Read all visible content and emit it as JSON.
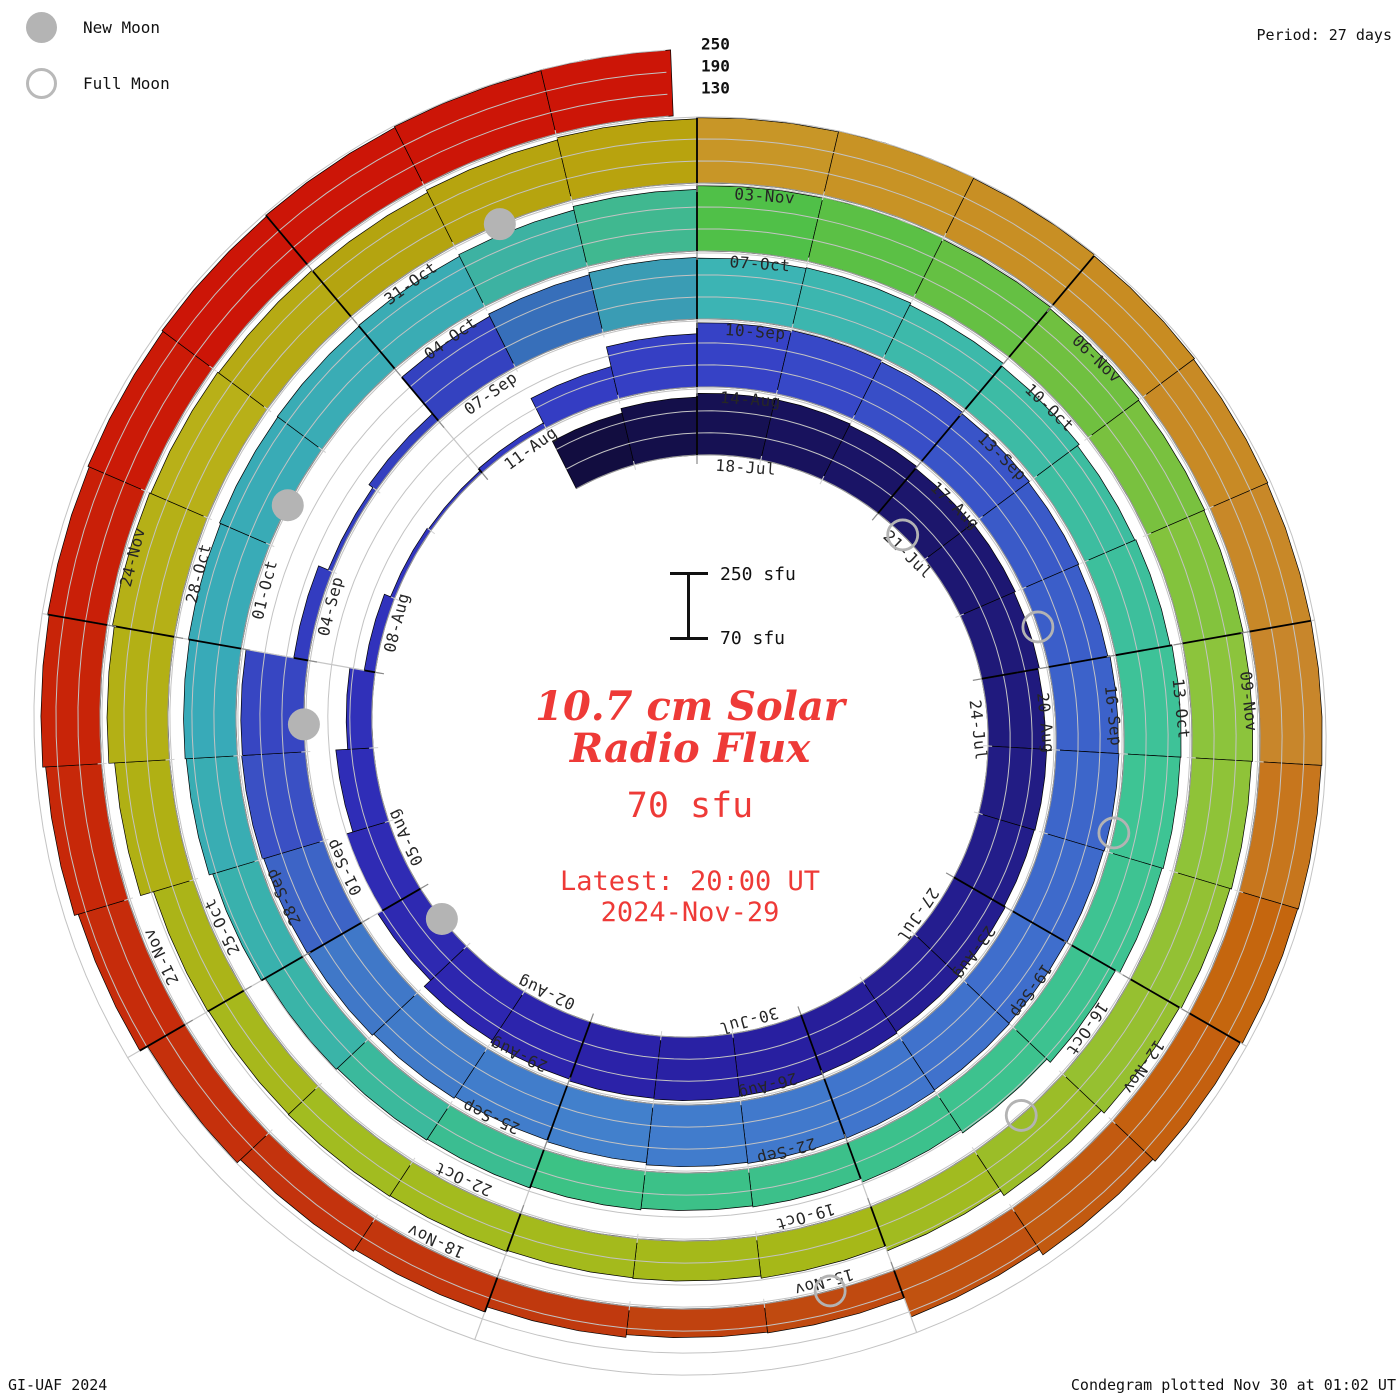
{
  "header": {
    "period_label": "Period: 27 days",
    "credit": "GI-UAF 2024",
    "plotted_label": "Condegram plotted Nov 30 at 01:02 UT"
  },
  "legend": {
    "new_moon_label": "New Moon",
    "full_moon_label": "Full Moon"
  },
  "center_text": {
    "title_line1": "10.7 cm Solar",
    "title_line2": "Radio Flux",
    "flux_value": "70 sfu",
    "latest_line1": "Latest: 20:00 UT",
    "latest_line2": "2024-Nov-29",
    "accent_color": "#ee3a37"
  },
  "scale_bar": {
    "top_label": "250 sfu",
    "bottom_label": "70 sfu"
  },
  "chart_data": {
    "type": "bar",
    "subtype": "condegram-spiral-polar-bars",
    "title": "10.7 cm Solar Radio Flux",
    "period_days": 27,
    "start_date": "2024-07-16",
    "end_date": "2024-11-29",
    "top_of_spiral_dates": [
      "18-Jul",
      "14-Aug",
      "10-Sep",
      "07-Oct",
      "03-Nov"
    ],
    "flux_axis": {
      "min": 70,
      "max": 250,
      "gridlines": [
        130,
        190,
        250
      ],
      "unit": "sfu"
    },
    "radial_axis_labels": [
      "250",
      "190",
      "130"
    ],
    "date_labels": [
      "18-Jul",
      "21-Jul",
      "24-Jul",
      "27-Jul",
      "30-Jul",
      "02-Aug",
      "05-Aug",
      "08-Aug",
      "11-Aug",
      "14-Aug",
      "17-Aug",
      "20-Aug",
      "23-Aug",
      "26-Aug",
      "29-Aug",
      "01-Sep",
      "04-Sep",
      "07-Sep",
      "10-Sep",
      "13-Sep",
      "16-Sep",
      "19-Sep",
      "22-Sep",
      "25-Sep",
      "28-Sep",
      "01-Oct",
      "04-Oct",
      "07-Oct",
      "10-Oct",
      "13-Oct",
      "16-Oct",
      "19-Oct",
      "22-Oct",
      "25-Oct",
      "28-Oct",
      "31-Oct",
      "03-Nov",
      "06-Nov",
      "09-Nov",
      "12-Nov",
      "15-Nov",
      "18-Nov",
      "21-Nov",
      "24-Nov"
    ],
    "date_label_first_day_index": 2,
    "date_label_step": 3,
    "flux_sfu": [
      215,
      228,
      238,
      240,
      236,
      230,
      234,
      230,
      226,
      230,
      228,
      232,
      236,
      240,
      242,
      243,
      241,
      236,
      229,
      205,
      190,
      172,
      140,
      100,
      82,
      78,
      85,
      160,
      215,
      245,
      248,
      244,
      240,
      237,
      234,
      240,
      242,
      240,
      238,
      240,
      243,
      241,
      238,
      232,
      228,
      233,
      238,
      240,
      244,
      242,
      110,
      82,
      95,
      225,
      232,
      238,
      236,
      238,
      232,
      224,
      218,
      221,
      226,
      224,
      221,
      208,
      195,
      185,
      175,
      172,
      176,
      181,
      184,
      188,
      200,
      210,
      213,
      216,
      219,
      221,
      223,
      228,
      238,
      248,
      250,
      247,
      243,
      240,
      238,
      236,
      233,
      229,
      224,
      214,
      199,
      185,
      179,
      177,
      180,
      182,
      181,
      183,
      220,
      236,
      241,
      238,
      235,
      232,
      239,
      245,
      248,
      250,
      248,
      245,
      242,
      240,
      240,
      238,
      236,
      230,
      222,
      205,
      150,
      148,
      155,
      170,
      176,
      188,
      212,
      223,
      231,
      235,
      239,
      242,
      245,
      248,
      250
    ],
    "last_day_fraction": 0.833,
    "color_stops": [
      [
        0,
        "#120d40"
      ],
      [
        4,
        "#1a1466"
      ],
      [
        9,
        "#221c84"
      ],
      [
        14,
        "#281fa0"
      ],
      [
        17,
        "#2c24ac"
      ],
      [
        23,
        "#3132bc"
      ],
      [
        29,
        "#3642c6"
      ],
      [
        33,
        "#3a5ac8"
      ],
      [
        38,
        "#3f6ecc"
      ],
      [
        43,
        "#4280cc"
      ],
      [
        46,
        "#4078c8"
      ],
      [
        48,
        "#3a50c4"
      ],
      [
        50,
        "#333cc0"
      ],
      [
        53,
        "#3442c0"
      ],
      [
        55,
        "#3a9cb4"
      ],
      [
        56,
        "#3cb4b4"
      ],
      [
        60,
        "#3dbda0"
      ],
      [
        63,
        "#3ec494"
      ],
      [
        68,
        "#3cc08a"
      ],
      [
        70,
        "#3cc285"
      ],
      [
        73,
        "#3ab4a8"
      ],
      [
        76,
        "#38aab8"
      ],
      [
        80,
        "#3aacb4"
      ],
      [
        82,
        "#40b890"
      ],
      [
        83,
        "#50c048"
      ],
      [
        86,
        "#70c040"
      ],
      [
        89,
        "#8cc43c"
      ],
      [
        92,
        "#96c030"
      ],
      [
        95,
        "#a6b818"
      ],
      [
        99,
        "#a2bc20"
      ],
      [
        102,
        "#b0b014"
      ],
      [
        105,
        "#b8b018"
      ],
      [
        107,
        "#b4a410"
      ],
      [
        109,
        "#b8a30e"
      ],
      [
        110,
        "#c89627"
      ],
      [
        113,
        "#c88c22"
      ],
      [
        116,
        "#c8862b"
      ],
      [
        118,
        "#c5660e"
      ],
      [
        120,
        "#c25a10"
      ],
      [
        122,
        "#c04a10"
      ],
      [
        124,
        "#c0390e"
      ],
      [
        127,
        "#c5300c"
      ],
      [
        130,
        "#c82408"
      ],
      [
        133,
        "#cc1507"
      ],
      [
        136,
        "#cc1507"
      ]
    ],
    "moons": [
      {
        "date": "2024-07-21",
        "type": "full",
        "day_pos": 5.5
      },
      {
        "date": "2024-08-04",
        "type": "new",
        "day_pos": 19.5
      },
      {
        "date": "2024-08-19",
        "type": "full",
        "day_pos": 34.5
      },
      {
        "date": "2024-09-03",
        "type": "new",
        "day_pos": 49.3
      },
      {
        "date": "2024-09-17",
        "type": "full",
        "day_pos": 63.8
      },
      {
        "date": "2024-10-02",
        "type": "new",
        "day_pos": 78.4
      },
      {
        "date": "2024-10-17",
        "type": "full",
        "day_pos": 93.5
      },
      {
        "date": "2024-11-01",
        "type": "new",
        "day_pos": 108.4
      },
      {
        "date": "2024-11-15",
        "type": "full",
        "day_pos": 122.5
      }
    ],
    "style": {
      "grid_color": "#c3c3c3",
      "baseline_color": "#9a9a9a",
      "bar_outline": "#000000",
      "label_color": "#262626",
      "moon_gray": "#b3b3b3"
    }
  }
}
